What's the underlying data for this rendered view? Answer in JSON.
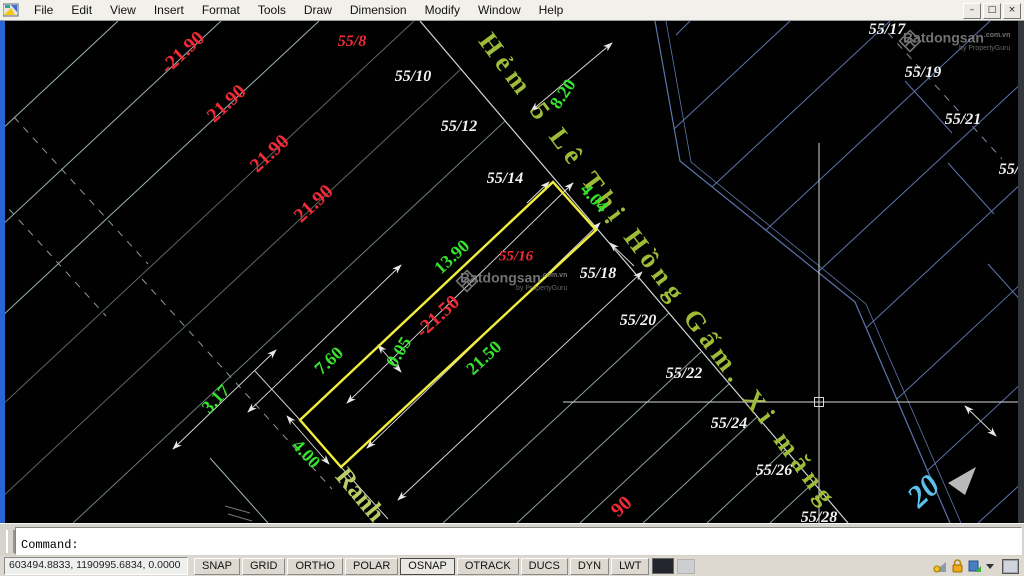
{
  "palette": {
    "red": "#ef2b36",
    "green": "#35e52d",
    "white": "#f2f2f2",
    "cyan": "#5bc0ea",
    "olive": "#9fbc39",
    "yellow": "#f2ee3c",
    "line_left": "#9fb4b4",
    "line_right": "#5e74ad"
  },
  "menubar": {
    "items": [
      "File",
      "Edit",
      "View",
      "Insert",
      "Format",
      "Tools",
      "Draw",
      "Dimension",
      "Modify",
      "Window",
      "Help"
    ]
  },
  "window_controls": [
    {
      "name": "minimize",
      "glyph": "–"
    },
    {
      "name": "restore",
      "glyph": "□"
    },
    {
      "name": "close",
      "glyph": "×"
    }
  ],
  "canvas": {
    "street_label": "Hẻm 5 Lê Thị Hồng Gấm. Xi măng",
    "ranh_label": "Ranh",
    "corner_label": "20",
    "watermark": {
      "brand": "Batdongsan",
      "suffix": ".com.vn",
      "tagline": "by PropertyGuru"
    },
    "labels": [
      {
        "id": "dim-21-90-a",
        "text": "-21.90",
        "x": 183,
        "y": 32,
        "rot": -43,
        "size": 20,
        "color": "red"
      },
      {
        "id": "dim-21-90-b",
        "text": "21.90",
        "x": 227,
        "y": 83,
        "rot": -43,
        "size": 20,
        "color": "red"
      },
      {
        "id": "dim-21-90-c",
        "text": "21.90",
        "x": 270,
        "y": 133,
        "rot": -43,
        "size": 20,
        "color": "red"
      },
      {
        "id": "dim-21-90-d",
        "text": "21.90",
        "x": 314,
        "y": 183,
        "rot": -43,
        "size": 20,
        "color": "red"
      },
      {
        "id": "dim-21-50-red",
        "text": "-21.50",
        "x": 438,
        "y": 296,
        "rot": -43,
        "size": 20,
        "color": "red"
      },
      {
        "id": "dim-90-partial",
        "text": "90",
        "x": 622,
        "y": 486,
        "rot": -43,
        "size": 20,
        "color": "red"
      },
      {
        "id": "parcel-55-8",
        "text": "55/8",
        "x": 352,
        "y": 21,
        "rot": 0,
        "size": 16,
        "color": "red",
        "upright": true
      },
      {
        "id": "parcel-55-16",
        "text": "55/16",
        "x": 516,
        "y": 236,
        "rot": 0,
        "size": 15,
        "color": "red",
        "upright": true
      },
      {
        "id": "dim-8-20",
        "text": "8.20",
        "x": 563,
        "y": 73,
        "rot": -56,
        "size": 18,
        "color": "green"
      },
      {
        "id": "dim-4-04",
        "text": "4.04",
        "x": 594,
        "y": 177,
        "rot": 48,
        "size": 18,
        "color": "green"
      },
      {
        "id": "dim-13-90",
        "text": "13.90",
        "x": 452,
        "y": 236,
        "rot": -43,
        "size": 18,
        "color": "green"
      },
      {
        "id": "dim-7-60",
        "text": "7.60",
        "x": 329,
        "y": 340,
        "rot": -43,
        "size": 18,
        "color": "green"
      },
      {
        "id": "dim-0-05",
        "text": "0.05",
        "x": 399,
        "y": 331,
        "rot": -58,
        "size": 18,
        "color": "green"
      },
      {
        "id": "dim-21-50-green",
        "text": "21.50",
        "x": 484,
        "y": 337,
        "rot": -43,
        "size": 18,
        "color": "green"
      },
      {
        "id": "dim-3-17",
        "text": "3.17",
        "x": 216,
        "y": 378,
        "rot": -47,
        "size": 18,
        "color": "green"
      },
      {
        "id": "dim-4-00",
        "text": "4.00",
        "x": 306,
        "y": 433,
        "rot": 47,
        "size": 18,
        "color": "green"
      },
      {
        "id": "parcel-55-10",
        "text": "55/10",
        "x": 413,
        "y": 56,
        "rot": 0,
        "size": 16,
        "color": "white",
        "upright": true
      },
      {
        "id": "parcel-55-12",
        "text": "55/12",
        "x": 459,
        "y": 106,
        "rot": 0,
        "size": 16,
        "color": "white",
        "upright": true
      },
      {
        "id": "parcel-55-14",
        "text": "55/14",
        "x": 505,
        "y": 158,
        "rot": 0,
        "size": 16,
        "color": "white",
        "upright": true
      },
      {
        "id": "parcel-55-18",
        "text": "55/18",
        "x": 598,
        "y": 253,
        "rot": 0,
        "size": 16,
        "color": "white",
        "upright": true
      },
      {
        "id": "parcel-55-20",
        "text": "55/20",
        "x": 638,
        "y": 300,
        "rot": 0,
        "size": 16,
        "color": "white",
        "upright": true
      },
      {
        "id": "parcel-55-22",
        "text": "55/22",
        "x": 684,
        "y": 353,
        "rot": 0,
        "size": 16,
        "color": "white",
        "upright": true
      },
      {
        "id": "parcel-55-24",
        "text": "55/24",
        "x": 729,
        "y": 403,
        "rot": 0,
        "size": 16,
        "color": "white",
        "upright": true
      },
      {
        "id": "parcel-55-26",
        "text": "55/26",
        "x": 774,
        "y": 450,
        "rot": 0,
        "size": 16,
        "color": "white",
        "upright": true
      },
      {
        "id": "parcel-55-28",
        "text": "55/28",
        "x": 819,
        "y": 497,
        "rot": 0,
        "size": 16,
        "color": "white",
        "upright": true
      },
      {
        "id": "parcel-55-17",
        "text": "55/17",
        "x": 887,
        "y": 9,
        "rot": 0,
        "size": 16,
        "color": "white",
        "upright": true
      },
      {
        "id": "parcel-55-19",
        "text": "55/19",
        "x": 923,
        "y": 52,
        "rot": 0,
        "size": 16,
        "color": "white",
        "upright": true
      },
      {
        "id": "parcel-55-21",
        "text": "55/21",
        "x": 963,
        "y": 99,
        "rot": 0,
        "size": 16,
        "color": "white",
        "upright": true
      },
      {
        "id": "parcel-55-2x",
        "text": "55/2",
        "x": 1013,
        "y": 149,
        "rot": 0,
        "size": 16,
        "color": "white",
        "upright": true
      }
    ]
  },
  "command": {
    "prompt": "Command:"
  },
  "statusbar": {
    "coords": "603494.8833, 1190995.6834, 0.0000",
    "toggles": [
      "SNAP",
      "GRID",
      "ORTHO",
      "POLAR",
      "OSNAP",
      "OTRACK",
      "DUCS",
      "DYN",
      "LWT"
    ],
    "active": "OSNAP"
  }
}
